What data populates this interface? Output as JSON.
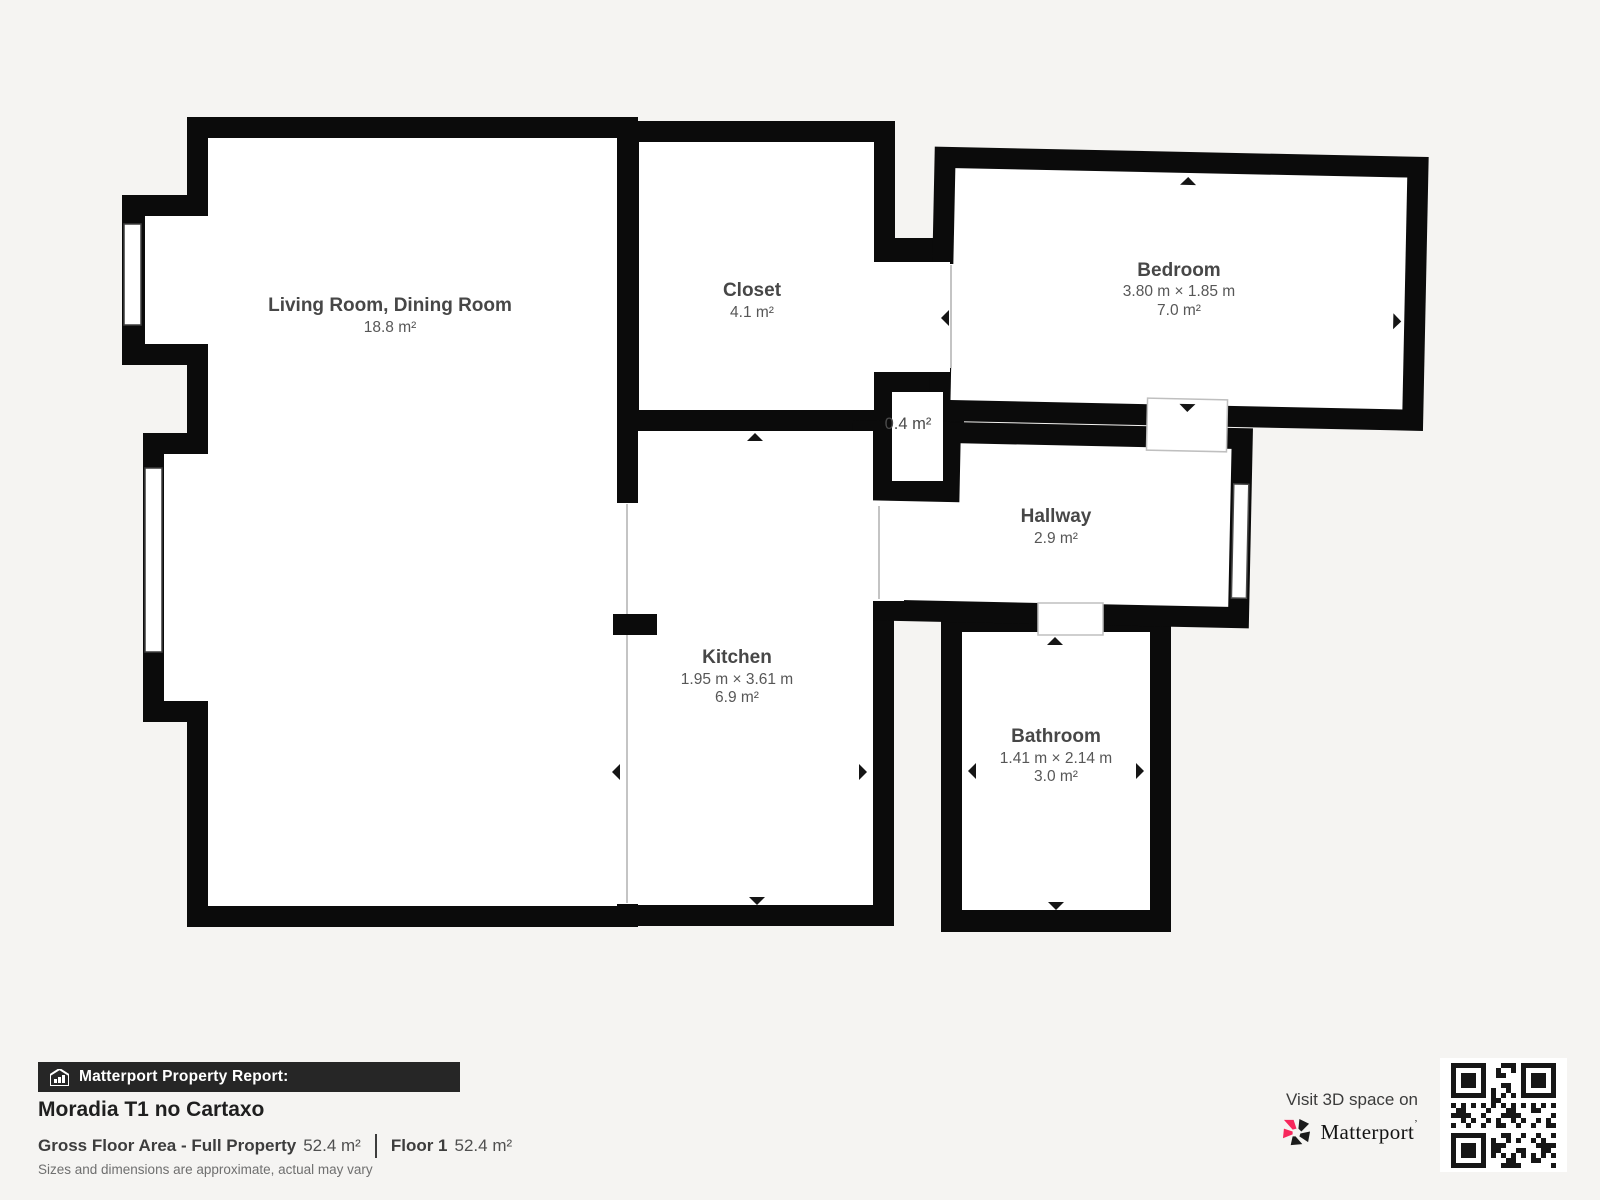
{
  "floorplan": {
    "rooms": [
      {
        "name": "Living Room, Dining Room",
        "dims": "",
        "area": "18.8 m²"
      },
      {
        "name": "Closet",
        "dims": "",
        "area": "4.1 m²"
      },
      {
        "name": "Bedroom",
        "dims": "3.80 m × 1.85 m",
        "area": "7.0 m²"
      },
      {
        "name": "",
        "dims": "",
        "area": "0.4 m²"
      },
      {
        "name": "Hallway",
        "dims": "",
        "area": "2.9 m²"
      },
      {
        "name": "Kitchen",
        "dims": "1.95 m × 3.61 m",
        "area": "6.9 m²"
      },
      {
        "name": "Bathroom",
        "dims": "1.41 m × 2.14 m",
        "area": "3.0 m²"
      }
    ]
  },
  "report": {
    "header": "Matterport Property Report:",
    "title": "Moradia T1 no Cartaxo",
    "gross_label": "Gross Floor Area - Full Property",
    "gross_value": "52.4 m²",
    "floor_label": "Floor 1",
    "floor_value": "52.4 m²",
    "disclaimer": "Sizes and dimensions are approximate, actual may vary"
  },
  "promo": {
    "visit": "Visit 3D space on",
    "brand": "Matterport"
  },
  "colors": {
    "background": "#f5f4f2",
    "wall": "#0b0b0b",
    "room_fill": "#ffffff",
    "brand_red": "#f7275c",
    "bar_background": "#262626"
  }
}
